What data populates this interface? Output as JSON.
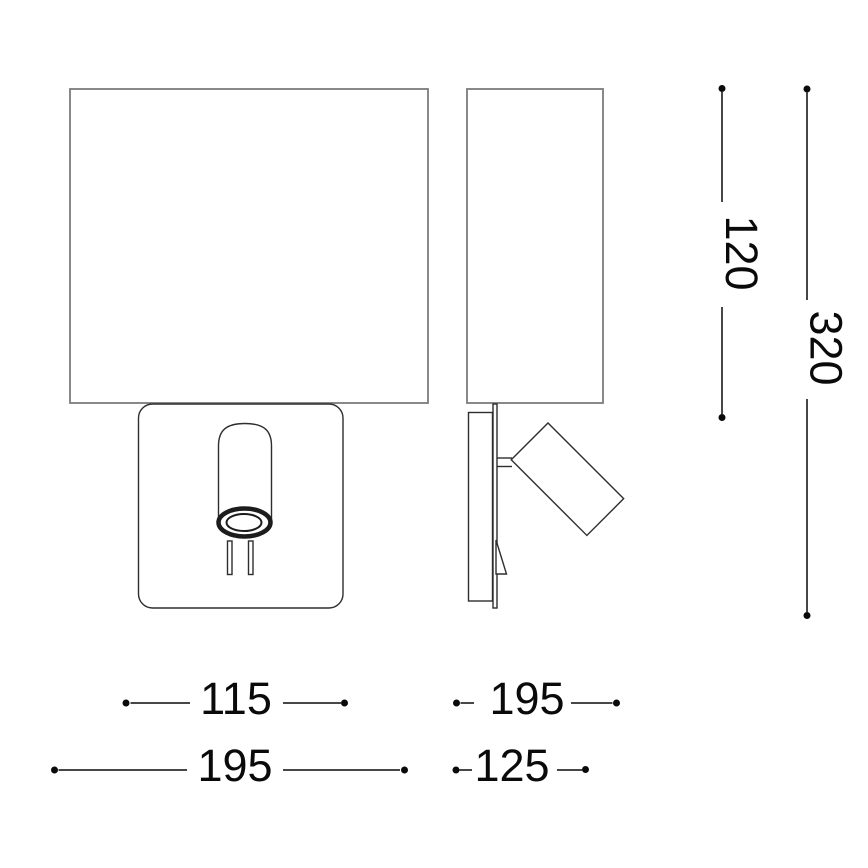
{
  "dimensions": {
    "shade_height": "120",
    "total_height": "320",
    "backplate_width": "115",
    "shade_width_front": "195",
    "shade_width_side": "195",
    "mount_depth": "125"
  },
  "colors": {
    "background": "#ffffff",
    "outline_gray": "#7c7c7c",
    "detail_dark": "#2e2e2e",
    "lens_black": "#1c1c1c",
    "dimension_black": "#0a0a0a"
  }
}
